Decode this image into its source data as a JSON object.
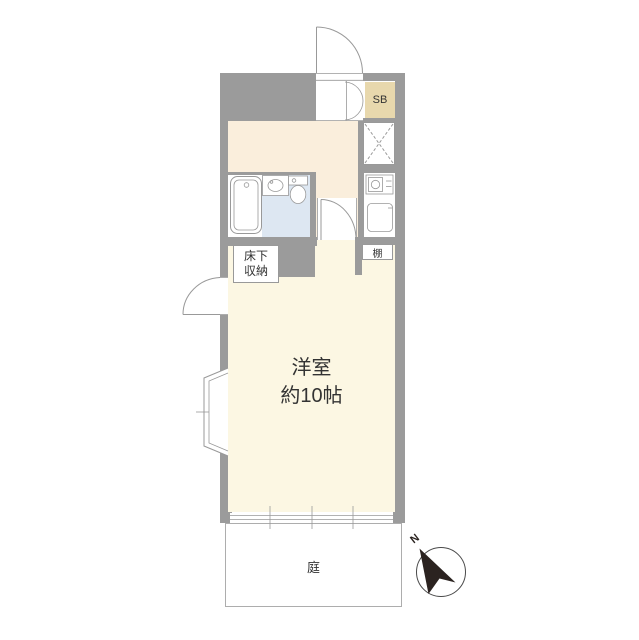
{
  "document_type": "floor-plan",
  "colors": {
    "wall": "#9b9b9b",
    "kitchen_floor": "#faeedc",
    "room_floor": "#fcf7e3",
    "bath_floor": "#dde7f2",
    "shoebox_fill": "#e8d8ad",
    "line": "#999999",
    "text": "#333333",
    "compass": "#2b2320"
  },
  "labels": {
    "main_room_line1": "洋室",
    "main_room_line2": "約10帖",
    "underfloor_storage_line1": "床下",
    "underfloor_storage_line2": "収納",
    "shelf": "棚",
    "shoe_box": "SB",
    "garden": "庭",
    "compass_north": "N"
  }
}
